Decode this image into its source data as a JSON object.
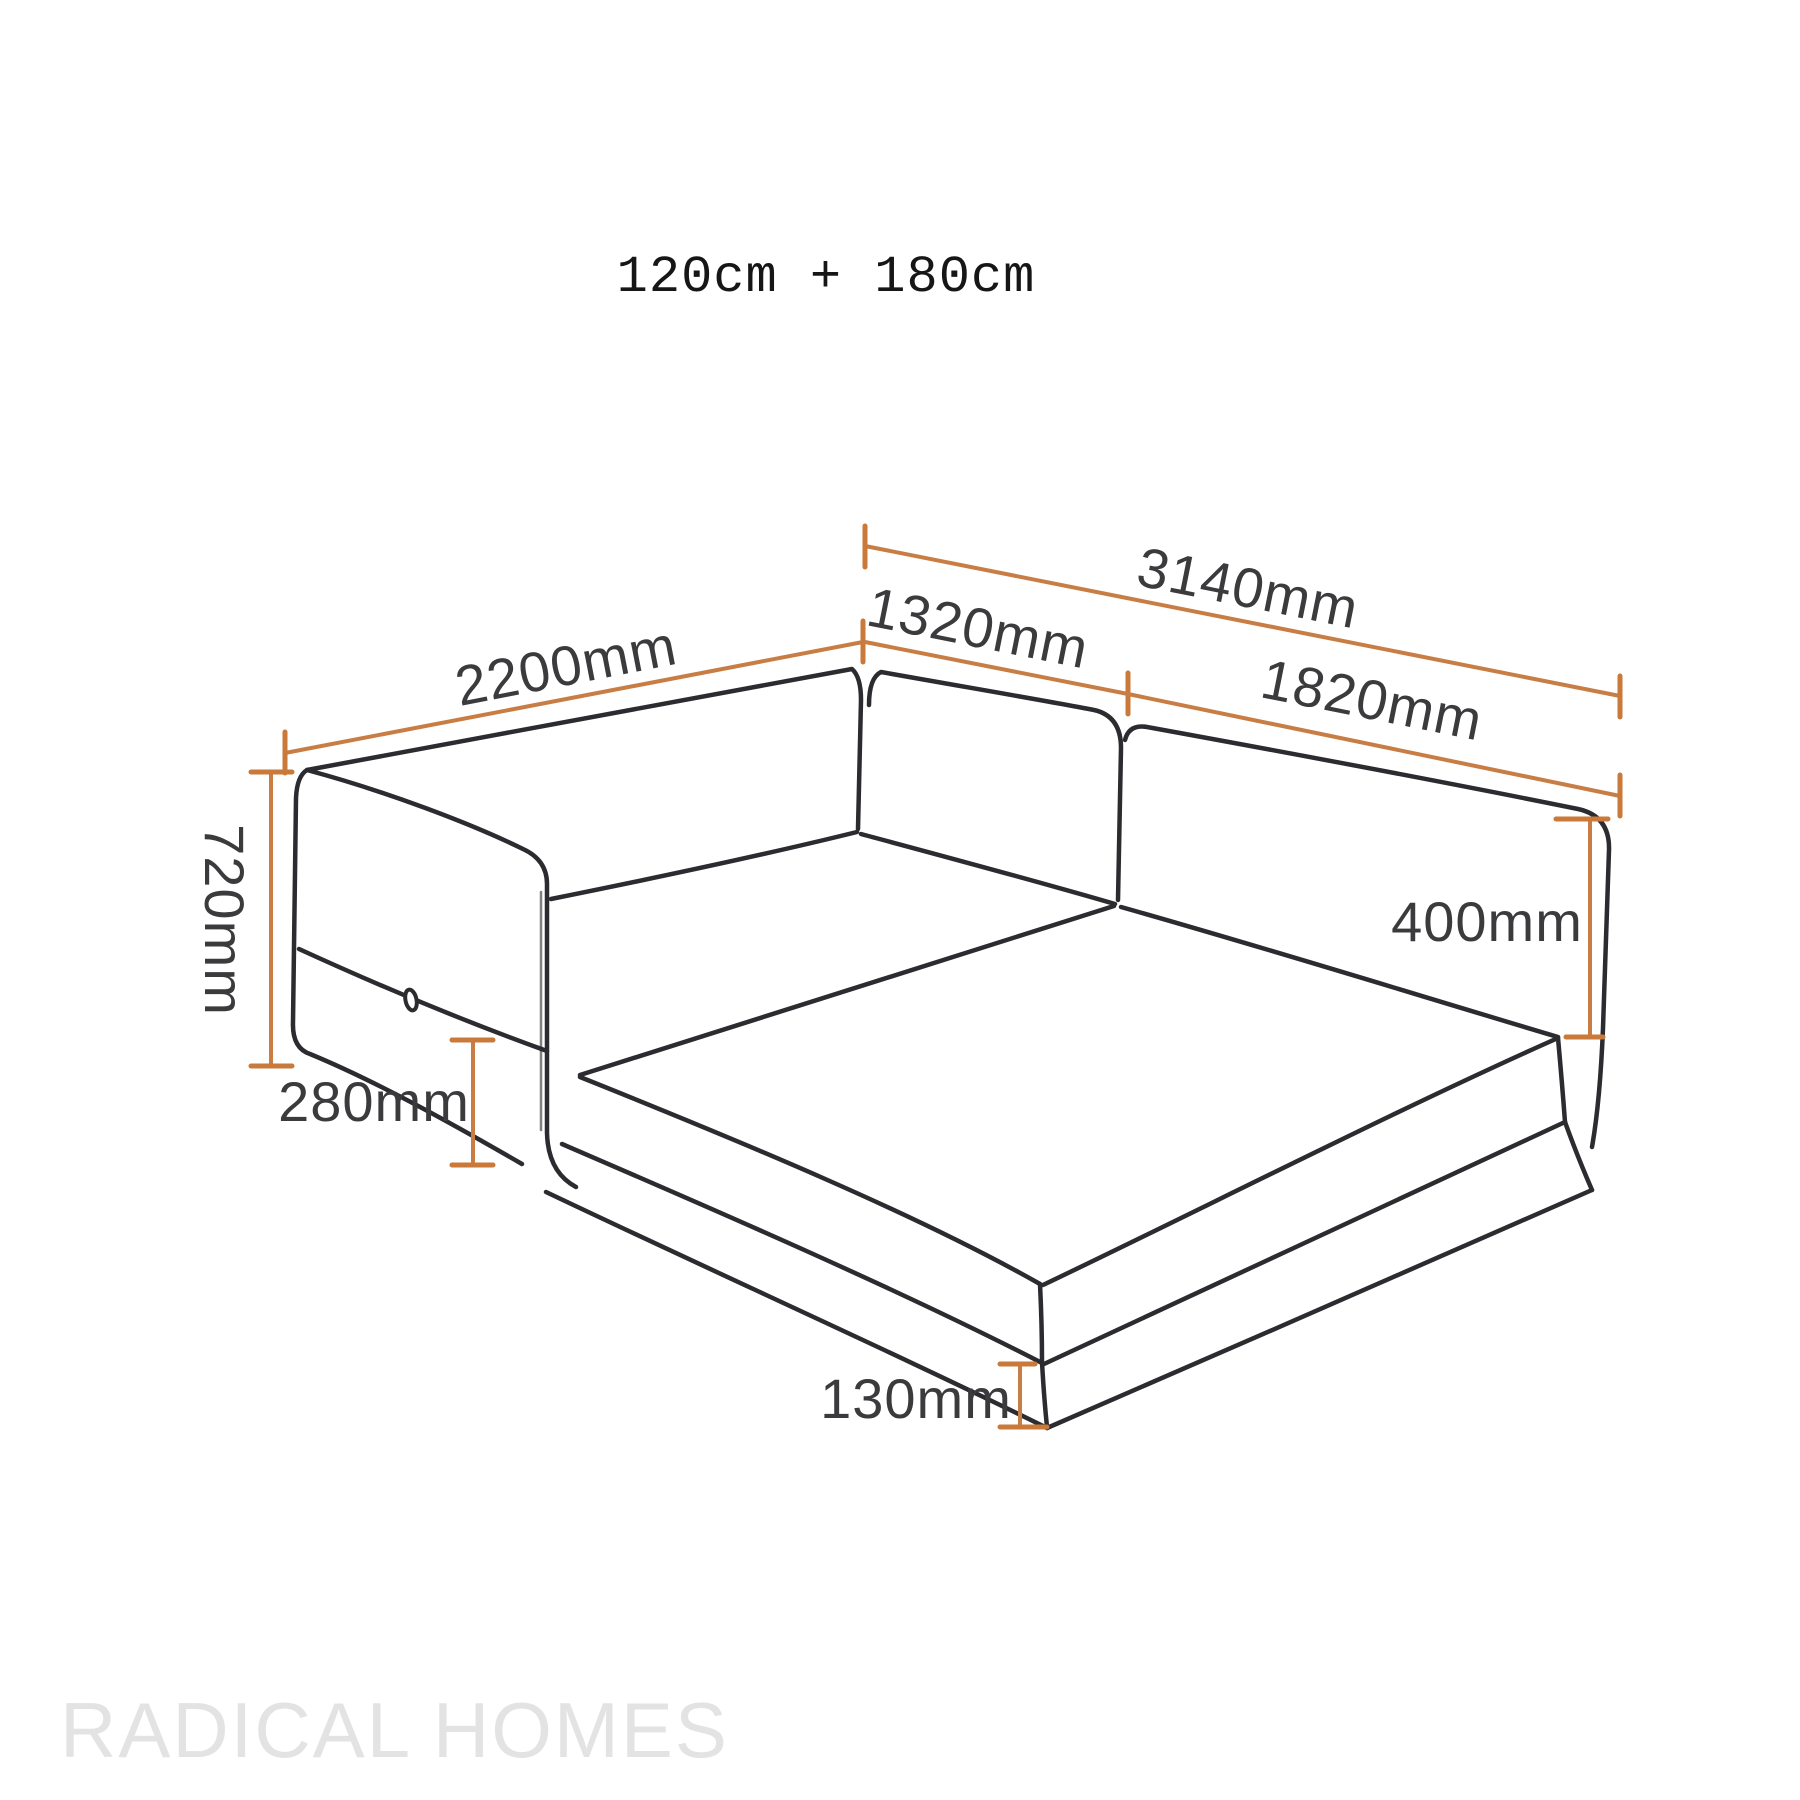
{
  "title": {
    "text": "120cm + 180cm"
  },
  "watermark": {
    "text": "RADICAL HOMES"
  },
  "colors": {
    "background": "#ffffff",
    "drawing_line": "#2b2b30",
    "dimension_line": "#c87d45",
    "dimension_text": "#3b3b3e",
    "title_text": "#161616",
    "watermark_text": "#e3e3e3"
  },
  "diagram": {
    "type": "isometric furniture dimension line drawing",
    "subject": "L-shaped modular sofa bed with armrest, two backrest panels, fold-out mattress and low base platform",
    "units": "mm",
    "dimensions": [
      {
        "label": "2200mm",
        "value": 2200,
        "measures": "depth of chaise section along back-left edge"
      },
      {
        "label": "3140mm",
        "value": 3140,
        "measures": "overall width along back edge"
      },
      {
        "label": "1320mm",
        "value": 1320,
        "measures": "left backrest panel width"
      },
      {
        "label": "1820mm",
        "value": 1820,
        "measures": "right backrest panel width"
      },
      {
        "label": "720mm",
        "value": 720,
        "measures": "overall height at armrest side"
      },
      {
        "label": "280mm",
        "value": 280,
        "measures": "armrest lower section height"
      },
      {
        "label": "400mm",
        "value": 400,
        "measures": "backrest height above mattress"
      },
      {
        "label": "130mm",
        "value": 130,
        "measures": "base platform height at front corner"
      }
    ]
  }
}
